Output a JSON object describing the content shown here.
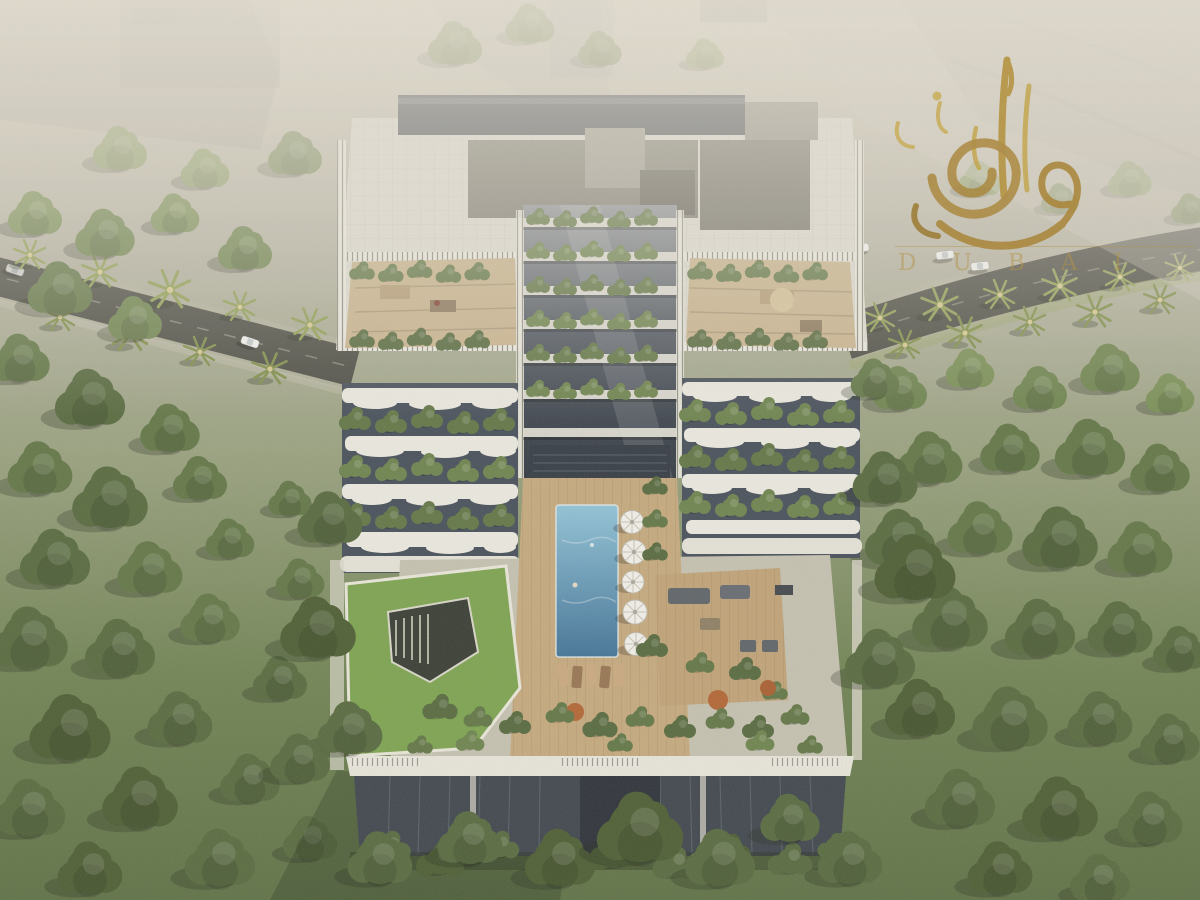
{
  "image": {
    "kind": "architectural aerial rendering",
    "subject": "Bird's-eye view of a white mid-rise residential building with terraced green balconies, rooftop terraces, a central atrium and a podium swimming pool, surrounded by dense trees and palm-lined roads"
  },
  "watermark": {
    "wordmark": "DUBAI",
    "color": "#b39347"
  },
  "palette": {
    "haze": "#e8e2d6",
    "canopy_dark": "#48592e",
    "canopy_mid": "#5e7342",
    "canopy_light": "#83985c",
    "road": "#474740",
    "building_white": "#e9e6dd",
    "glass_dark": "#394049",
    "roof_gray": "#7b786f",
    "pool_blue": "#4f86ad",
    "deck_wood": "#c6a87c",
    "lawn": "#7aa24c",
    "umbrella": "#f4f2ec",
    "gold": "#a9863b"
  },
  "scene": {
    "pool_umbrellas": 5,
    "elements": [
      "hazy-city-background",
      "tree-canopy",
      "palm-lined-road",
      "cars",
      "residential-building",
      "rooftop-terraces",
      "central-atrium",
      "terraced-balconies",
      "podium-garden",
      "swimming-pool",
      "pool-umbrellas",
      "sun-loungers",
      "green-lawn",
      "outdoor-lounge-deck",
      "front-facade",
      "developer-watermark-logo"
    ]
  }
}
